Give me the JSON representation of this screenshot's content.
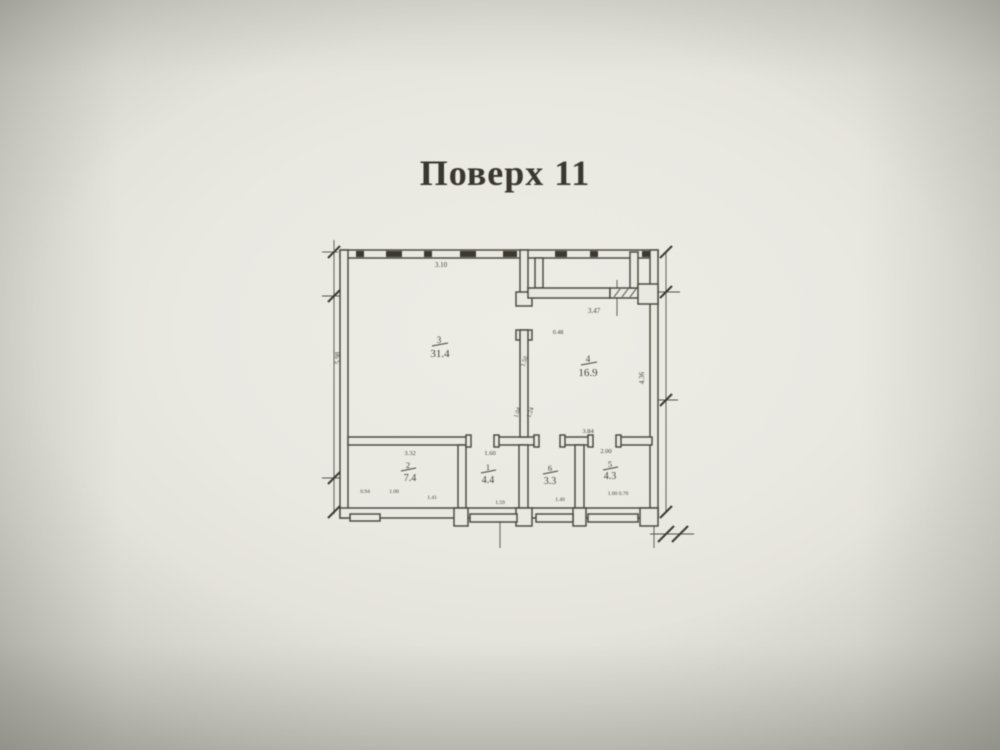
{
  "page": {
    "title": "Поверх 11"
  },
  "floor_plan": {
    "rooms": [
      {
        "number": "3",
        "area": "31.4"
      },
      {
        "number": "4",
        "area": "16.9"
      },
      {
        "number": "2",
        "area": "7.4"
      },
      {
        "number": "1",
        "area": "4.4"
      },
      {
        "number": "6",
        "area": "3.3"
      },
      {
        "number": "5",
        "area": "4.3"
      }
    ],
    "dimensions": {
      "top": "3.10",
      "left": "5.98",
      "right": "4.36",
      "balcony": "3.47",
      "door": "0.48",
      "mid_a": "1.50",
      "mid_b": "1.04",
      "mid_c": "1.24",
      "hall": "3.84",
      "room5_top": "2.00",
      "room2_top": "3.32",
      "room1_top": "1.60",
      "bottom": [
        "0.94",
        "1.00",
        "1.41",
        "1.59",
        "1.40",
        "1.00 0.70"
      ]
    },
    "colors": {
      "paper": "#e9e8e1",
      "ink": "#45433a"
    }
  }
}
